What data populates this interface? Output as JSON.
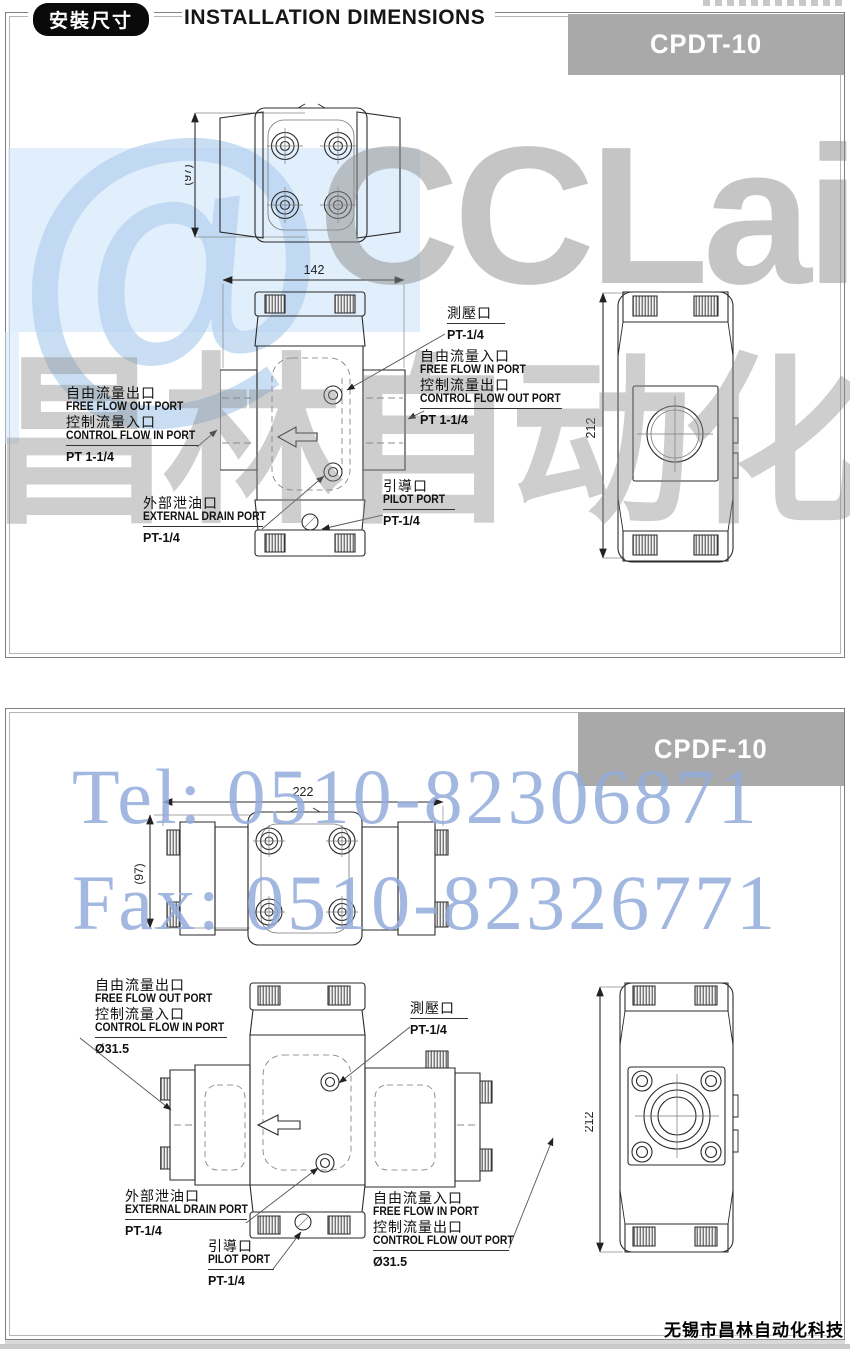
{
  "header": {
    "badge": "安裝尺寸",
    "title": "INSTALLATION DIMENSIONS"
  },
  "watermarks": {
    "at_glyph": "@",
    "logo": "CCLair",
    "brand_cn": "昌林自动化",
    "tel": "Tel: 0510-82306871",
    "fax": "Fax: 0510-82326771"
  },
  "footer": {
    "company": "无锡市昌林自动化科技"
  },
  "colors": {
    "banner_gray": "#a9a9a9",
    "watermark_blue": "#93acdb",
    "watermark_gray": "#8d8d8d"
  },
  "panels": [
    {
      "model": "CPDT-10",
      "dims": {
        "width": "142",
        "depth": "(97)",
        "height": "212"
      },
      "ports": {
        "test": {
          "zh": "測壓口",
          "size": "PT-1/4"
        },
        "flow_left": {
          "zh1": "自由流量出口",
          "en1": "FREE FLOW OUT PORT",
          "zh2": "控制流量入口",
          "en2": "CONTROL FLOW IN PORT",
          "size": "PT 1-1/4"
        },
        "flow_right": {
          "zh1": "自由流量入口",
          "en1": "FREE FLOW IN PORT",
          "zh2": "控制流量出口",
          "en2": "CONTROL FLOW OUT PORT",
          "size": "PT 1-1/4"
        },
        "drain": {
          "zh": "外部泄油口",
          "en": "EXTERNAL DRAIN PORT",
          "size": "PT-1/4"
        },
        "pilot": {
          "zh": "引導口",
          "en": "PILOT PORT",
          "size": "PT-1/4"
        }
      }
    },
    {
      "model": "CPDF-10",
      "dims": {
        "width": "222",
        "depth": "(97)",
        "height": "212"
      },
      "ports": {
        "test": {
          "zh": "測壓口",
          "size": "PT-1/4"
        },
        "flow_left": {
          "zh1": "自由流量出口",
          "en1": "FREE FLOW OUT PORT",
          "zh2": "控制流量入口",
          "en2": "CONTROL FLOW IN PORT",
          "size": "Ø31.5"
        },
        "flow_right": {
          "zh1": "自由流量入口",
          "en1": "FREE FLOW IN PORT",
          "zh2": "控制流量出口",
          "en2": "CONTROL FLOW OUT PORT",
          "size": "Ø31.5"
        },
        "drain": {
          "zh": "外部泄油口",
          "en": "EXTERNAL DRAIN PORT",
          "size": "PT-1/4"
        },
        "pilot": {
          "zh": "引導口",
          "en": "PILOT PORT",
          "size": "PT-1/4"
        }
      }
    }
  ]
}
